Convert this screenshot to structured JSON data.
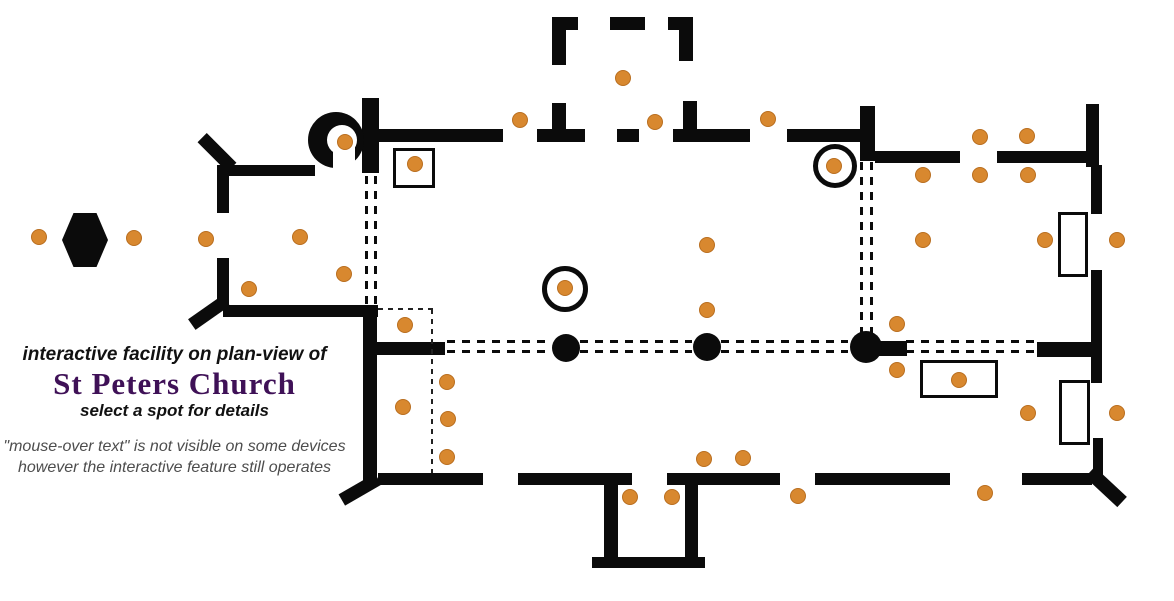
{
  "header": {
    "line_above": "interactive facility on plan-view of",
    "title": "St Peters Church",
    "line_below": "select a spot for details",
    "note1": "\"mouse-over text\" is not visible on some devices",
    "note2": "however the interactive feature still operates"
  },
  "colors": {
    "wall": "#0b0b0b",
    "spot_fill": "#d8882f",
    "spot_edge": "#b96e1f",
    "title_purple": "#3f1157",
    "note_gray": "#4d4d4d"
  },
  "plan": {
    "walls": [
      [
        362,
        98,
        17,
        75
      ],
      [
        378,
        129,
        125,
        13
      ],
      [
        537,
        129,
        48,
        13
      ],
      [
        552,
        103,
        14,
        28
      ],
      [
        552,
        17,
        14,
        48
      ],
      [
        552,
        17,
        26,
        13
      ],
      [
        610,
        17,
        35,
        13
      ],
      [
        668,
        17,
        25,
        13
      ],
      [
        679,
        17,
        14,
        44
      ],
      [
        617,
        129,
        22,
        13
      ],
      [
        683,
        101,
        14,
        30
      ],
      [
        673,
        129,
        77,
        13
      ],
      [
        787,
        129,
        75,
        13
      ],
      [
        860,
        106,
        15,
        55
      ],
      [
        875,
        151,
        85,
        12
      ],
      [
        997,
        151,
        91,
        12
      ],
      [
        1086,
        104,
        13,
        63
      ],
      [
        1091,
        165,
        11,
        49
      ],
      [
        1091,
        270,
        11,
        113
      ],
      [
        1093,
        438,
        10,
        40
      ],
      [
        1037,
        342,
        56,
        15
      ],
      [
        865,
        341,
        42,
        15
      ],
      [
        1022,
        473,
        70,
        12
      ],
      [
        815,
        473,
        135,
        12
      ],
      [
        667,
        473,
        113,
        12
      ],
      [
        518,
        473,
        114,
        12
      ],
      [
        378,
        473,
        105,
        12
      ],
      [
        604,
        473,
        14,
        86
      ],
      [
        685,
        478,
        13,
        81
      ],
      [
        592,
        557,
        113,
        11
      ],
      [
        223,
        305,
        155,
        12
      ],
      [
        363,
        305,
        14,
        178
      ],
      [
        367,
        342,
        78,
        13
      ],
      [
        217,
        165,
        12,
        48
      ],
      [
        217,
        258,
        12,
        48
      ],
      [
        223,
        165,
        92,
        11
      ]
    ],
    "buttresses": [
      [
        196,
        146,
        42,
        13,
        45
      ],
      [
        188,
        306,
        42,
        13,
        -35
      ],
      [
        339,
        483,
        42,
        13,
        -30
      ],
      [
        1084,
        480,
        44,
        14,
        43
      ]
    ],
    "dashed_double_v": [
      [
        366,
        176,
        129
      ],
      [
        375,
        176,
        129
      ],
      [
        861,
        162,
        171
      ],
      [
        871,
        162,
        171
      ]
    ],
    "dashed_double_h": [
      [
        447,
        341,
        104
      ],
      [
        447,
        351,
        104
      ],
      [
        580,
        341,
        112
      ],
      [
        580,
        351,
        112
      ],
      [
        721,
        341,
        127
      ],
      [
        721,
        351,
        127
      ],
      [
        906,
        341,
        130
      ],
      [
        906,
        351,
        130
      ]
    ],
    "dashed_single_h": [
      [
        378,
        309,
        56
      ]
    ],
    "dashed_single_v": [
      [
        432,
        309,
        164
      ]
    ],
    "circles": [
      [
        565,
        289,
        23
      ],
      [
        835,
        166,
        22
      ]
    ],
    "turret": {
      "outer": [
        336,
        140,
        28
      ],
      "inner": [
        342,
        140,
        15
      ],
      "channel": [
        333,
        140,
        22,
        33
      ]
    },
    "hexagon": [
      62,
      213,
      46,
      54
    ],
    "rects": [
      [
        393,
        148,
        42,
        40
      ],
      [
        1058,
        212,
        30,
        65
      ],
      [
        920,
        360,
        78,
        38
      ],
      [
        1059,
        380,
        31,
        65
      ]
    ],
    "pillars": [
      [
        566,
        348,
        14
      ],
      [
        707,
        347,
        14
      ],
      [
        866,
        347,
        16
      ]
    ],
    "spots": [
      [
        39,
        237
      ],
      [
        134,
        238
      ],
      [
        206,
        239
      ],
      [
        300,
        237
      ],
      [
        344,
        274
      ],
      [
        249,
        289
      ],
      [
        345,
        142
      ],
      [
        415,
        164
      ],
      [
        520,
        120
      ],
      [
        623,
        78
      ],
      [
        655,
        122
      ],
      [
        768,
        119
      ],
      [
        565,
        288
      ],
      [
        834,
        166
      ],
      [
        707,
        245
      ],
      [
        707,
        310
      ],
      [
        405,
        325
      ],
      [
        447,
        382
      ],
      [
        403,
        407
      ],
      [
        448,
        419
      ],
      [
        447,
        457
      ],
      [
        630,
        497
      ],
      [
        672,
        497
      ],
      [
        704,
        459
      ],
      [
        743,
        458
      ],
      [
        798,
        496
      ],
      [
        985,
        493
      ],
      [
        897,
        324
      ],
      [
        897,
        370
      ],
      [
        959,
        380
      ],
      [
        923,
        175
      ],
      [
        980,
        175
      ],
      [
        1028,
        175
      ],
      [
        980,
        137
      ],
      [
        1027,
        136
      ],
      [
        923,
        240
      ],
      [
        1045,
        240
      ],
      [
        1117,
        240
      ],
      [
        1028,
        413
      ],
      [
        1117,
        413
      ]
    ]
  }
}
